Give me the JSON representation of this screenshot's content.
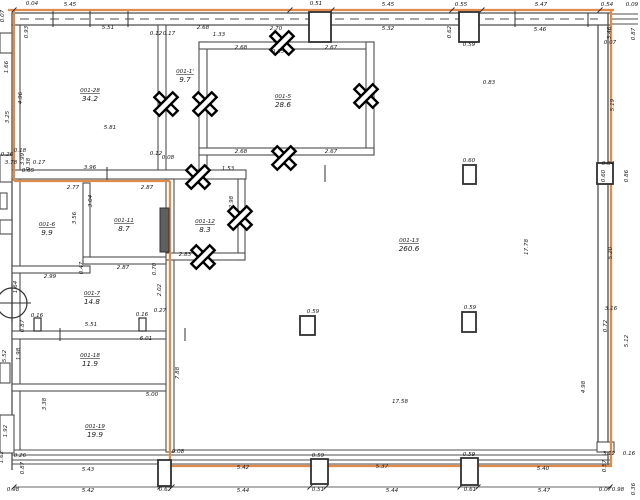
{
  "drawing": {
    "title": "floor-plan",
    "colors": {
      "accent": "#e08a4c",
      "wall": "#4f4f4f",
      "wall_dark": "#303030",
      "text": "#1a1a1a",
      "door_fill": "#5f5f5f",
      "background": "#ffffff"
    },
    "rooms": [
      {
        "id": "001-28",
        "area": "34.2",
        "x": 90,
        "y": 92
      },
      {
        "id": "001-1'",
        "area": "9.7",
        "x": 185,
        "y": 73
      },
      {
        "id": "001-5",
        "area": "28.6",
        "x": 283,
        "y": 98
      },
      {
        "id": "001-6",
        "area": "9.9",
        "x": 47,
        "y": 226
      },
      {
        "id": "001-11",
        "area": "8.7",
        "x": 124,
        "y": 222
      },
      {
        "id": "001-12",
        "area": "8.3",
        "x": 205,
        "y": 223
      },
      {
        "id": "001-7",
        "area": "14.8",
        "x": 92,
        "y": 295
      },
      {
        "id": "001-18",
        "area": "11.9",
        "x": 90,
        "y": 357
      },
      {
        "id": "001-19",
        "area": "19.9",
        "x": 95,
        "y": 428
      },
      {
        "id": "001-13",
        "area": "260.6",
        "x": 409,
        "y": 242
      }
    ],
    "dimensions": [
      {
        "t": "0.04",
        "x": 32,
        "y": 5
      },
      {
        "t": "5.45",
        "x": 70,
        "y": 6
      },
      {
        "t": "0.51",
        "x": 316,
        "y": 5
      },
      {
        "t": "5.45",
        "x": 388,
        "y": 6
      },
      {
        "t": "0.55",
        "x": 461,
        "y": 6
      },
      {
        "t": "5.47",
        "x": 541,
        "y": 6
      },
      {
        "t": "0.54",
        "x": 607,
        "y": 6
      },
      {
        "t": "0.09",
        "x": 632,
        "y": 6
      },
      {
        "t": "0.07",
        "x": 4,
        "y": 16,
        "r": 1
      },
      {
        "t": "5.51",
        "x": 108,
        "y": 29
      },
      {
        "t": "0.93",
        "x": 28,
        "y": 32,
        "r": 1
      },
      {
        "t": "0.12",
        "x": 156,
        "y": 35
      },
      {
        "t": "0.17",
        "x": 169,
        "y": 35
      },
      {
        "t": "2.68",
        "x": 203,
        "y": 29
      },
      {
        "t": "1.33",
        "x": 219,
        "y": 36
      },
      {
        "t": "2.70",
        "x": 276,
        "y": 30
      },
      {
        "t": "5.32",
        "x": 388,
        "y": 30
      },
      {
        "t": "5.46",
        "x": 540,
        "y": 31
      },
      {
        "t": "0.62",
        "x": 451,
        "y": 32,
        "r": 1
      },
      {
        "t": "0.59",
        "x": 469,
        "y": 46
      },
      {
        "t": "3.46",
        "x": 611,
        "y": 33,
        "r": 1
      },
      {
        "t": "0.07",
        "x": 610,
        "y": 44
      },
      {
        "t": "0.87",
        "x": 635,
        "y": 34,
        "r": 1
      },
      {
        "t": "2.68",
        "x": 241,
        "y": 49
      },
      {
        "t": "0.15",
        "x": 278,
        "y": 53
      },
      {
        "t": "2.67",
        "x": 331,
        "y": 49
      },
      {
        "t": "2.68",
        "x": 241,
        "y": 153
      },
      {
        "t": "2.67",
        "x": 331,
        "y": 153
      },
      {
        "t": "1.66",
        "x": 8,
        "y": 67,
        "r": 1
      },
      {
        "t": "4.96",
        "x": 22,
        "y": 98,
        "r": 1
      },
      {
        "t": "3.25",
        "x": 9,
        "y": 117,
        "r": 1
      },
      {
        "t": "5.81",
        "x": 110,
        "y": 129
      },
      {
        "t": "0.26",
        "x": 7,
        "y": 156
      },
      {
        "t": "0.18",
        "x": 20,
        "y": 152
      },
      {
        "t": "3.99",
        "x": 24,
        "y": 159,
        "r": 1
      },
      {
        "t": "0.38",
        "x": 30,
        "y": 164,
        "r": 1
      },
      {
        "t": "3.78",
        "x": 11,
        "y": 164
      },
      {
        "t": "0.17",
        "x": 39,
        "y": 164
      },
      {
        "t": "0.65",
        "x": 28,
        "y": 172
      },
      {
        "t": "3.96",
        "x": 90,
        "y": 169
      },
      {
        "t": "0.12",
        "x": 156,
        "y": 155
      },
      {
        "t": "0.08",
        "x": 168,
        "y": 159
      },
      {
        "t": "1.53",
        "x": 228,
        "y": 170
      },
      {
        "t": "2.77",
        "x": 73,
        "y": 189
      },
      {
        "t": "2.87",
        "x": 147,
        "y": 189
      },
      {
        "t": "3.04",
        "x": 92,
        "y": 201,
        "r": 1
      },
      {
        "t": "3.56",
        "x": 76,
        "y": 218,
        "r": 1
      },
      {
        "t": "2.98",
        "x": 233,
        "y": 202,
        "r": 1
      },
      {
        "t": "2.83",
        "x": 185,
        "y": 256
      },
      {
        "t": "2.99",
        "x": 50,
        "y": 278
      },
      {
        "t": "2.87",
        "x": 123,
        "y": 269
      },
      {
        "t": "0.47",
        "x": 83,
        "y": 268,
        "r": 1
      },
      {
        "t": "0.70",
        "x": 156,
        "y": 269,
        "r": 1
      },
      {
        "t": "1.64",
        "x": 17,
        "y": 287,
        "r": 1
      },
      {
        "t": "2.02",
        "x": 161,
        "y": 290,
        "r": 1
      },
      {
        "t": "0.27",
        "x": 160,
        "y": 312
      },
      {
        "t": "0.16",
        "x": 142,
        "y": 316
      },
      {
        "t": "0.16",
        "x": 37,
        "y": 317
      },
      {
        "t": "0.87",
        "x": 24,
        "y": 326,
        "r": 1
      },
      {
        "t": "5.51",
        "x": 91,
        "y": 326
      },
      {
        "t": "6.01",
        "x": 146,
        "y": 340
      },
      {
        "t": "1.98",
        "x": 20,
        "y": 354,
        "r": 1
      },
      {
        "t": "5.52",
        "x": 6,
        "y": 356,
        "r": 1
      },
      {
        "t": "3.38",
        "x": 46,
        "y": 404,
        "r": 1
      },
      {
        "t": "5.00",
        "x": 152,
        "y": 396
      },
      {
        "t": "1.92",
        "x": 7,
        "y": 431,
        "r": 1
      },
      {
        "t": "1.62",
        "x": 3,
        "y": 457,
        "r": 1
      },
      {
        "t": "0.26",
        "x": 20,
        "y": 457
      },
      {
        "t": "0.87",
        "x": 24,
        "y": 468,
        "r": 1
      },
      {
        "t": "0.83",
        "x": 489,
        "y": 84
      },
      {
        "t": "17.78",
        "x": 528,
        "y": 247,
        "r": 1
      },
      {
        "t": "17.58",
        "x": 400,
        "y": 403
      },
      {
        "t": "0.60",
        "x": 469,
        "y": 162
      },
      {
        "t": "0.59",
        "x": 470,
        "y": 309
      },
      {
        "t": "0.59",
        "x": 313,
        "y": 313
      },
      {
        "t": "7.88",
        "x": 179,
        "y": 373,
        "r": 1
      },
      {
        "t": "0.08",
        "x": 178,
        "y": 453
      },
      {
        "t": "4.98",
        "x": 585,
        "y": 387,
        "r": 1
      },
      {
        "t": "5.19",
        "x": 614,
        "y": 105,
        "r": 1
      },
      {
        "t": "0.04",
        "x": 608,
        "y": 165
      },
      {
        "t": "0.60",
        "x": 605,
        "y": 176,
        "r": 1
      },
      {
        "t": "0.86",
        "x": 628,
        "y": 176,
        "r": 1
      },
      {
        "t": "5.20",
        "x": 612,
        "y": 253,
        "r": 1
      },
      {
        "t": "3.16",
        "x": 611,
        "y": 310
      },
      {
        "t": "0.72",
        "x": 607,
        "y": 326,
        "r": 1
      },
      {
        "t": "5.12",
        "x": 628,
        "y": 341,
        "r": 1
      },
      {
        "t": "3.12",
        "x": 609,
        "y": 455
      },
      {
        "t": "0.16",
        "x": 629,
        "y": 455
      },
      {
        "t": "0.57",
        "x": 606,
        "y": 466,
        "r": 1
      },
      {
        "t": "5.43",
        "x": 88,
        "y": 471
      },
      {
        "t": "5.42",
        "x": 243,
        "y": 469
      },
      {
        "t": "5.37",
        "x": 382,
        "y": 468
      },
      {
        "t": "5.40",
        "x": 543,
        "y": 470
      },
      {
        "t": "0.59",
        "x": 318,
        "y": 457
      },
      {
        "t": "0.59",
        "x": 469,
        "y": 456
      },
      {
        "t": "0.98",
        "x": 13,
        "y": 491
      },
      {
        "t": "5.42",
        "x": 88,
        "y": 492
      },
      {
        "t": "0.62",
        "x": 165,
        "y": 491
      },
      {
        "t": "5.44",
        "x": 243,
        "y": 492
      },
      {
        "t": "0.51",
        "x": 318,
        "y": 491
      },
      {
        "t": "5.44",
        "x": 392,
        "y": 492
      },
      {
        "t": "0.61",
        "x": 470,
        "y": 491
      },
      {
        "t": "5.47",
        "x": 544,
        "y": 492
      },
      {
        "t": "0.07",
        "x": 605,
        "y": 491
      },
      {
        "t": "0.98",
        "x": 618,
        "y": 491
      },
      {
        "t": "0.36",
        "x": 635,
        "y": 489,
        "r": 1
      }
    ],
    "markers": [
      {
        "x": 166,
        "y": 104
      },
      {
        "x": 205,
        "y": 104
      },
      {
        "x": 282,
        "y": 43
      },
      {
        "x": 366,
        "y": 96
      },
      {
        "x": 284,
        "y": 158
      },
      {
        "x": 198,
        "y": 177
      },
      {
        "x": 240,
        "y": 218
      },
      {
        "x": 203,
        "y": 257
      }
    ],
    "columns": [
      {
        "x": 309,
        "y": 12,
        "w": 22,
        "h": 30
      },
      {
        "x": 459,
        "y": 12,
        "w": 20,
        "h": 30
      },
      {
        "x": 463,
        "y": 165,
        "w": 13,
        "h": 19
      },
      {
        "x": 462,
        "y": 312,
        "w": 14,
        "h": 20
      },
      {
        "x": 300,
        "y": 316,
        "w": 15,
        "h": 19
      },
      {
        "x": 158,
        "y": 460,
        "w": 13,
        "h": 26
      },
      {
        "x": 311,
        "y": 459,
        "w": 17,
        "h": 25
      },
      {
        "x": 461,
        "y": 458,
        "w": 17,
        "h": 27
      },
      {
        "x": 597,
        "y": 163,
        "w": 16,
        "h": 21
      }
    ],
    "doors": {
      "dark": {
        "x": 160,
        "y": 208,
        "w": 9,
        "h": 44
      },
      "small": [
        {
          "x": 34,
          "y": 318,
          "w": 7,
          "h": 13
        },
        {
          "x": 139,
          "y": 318,
          "w": 7,
          "h": 13
        }
      ]
    },
    "circle_symbol": {
      "cx": 12,
      "cy": 303,
      "r": 15
    }
  }
}
